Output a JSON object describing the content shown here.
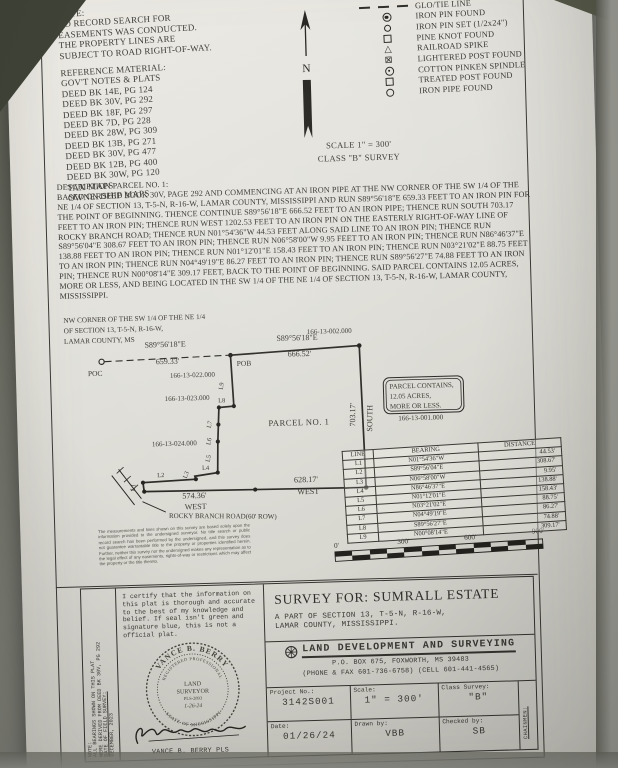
{
  "top_notes": {
    "title": "NOTE:",
    "lines": [
      "NO RECORD SEARCH FOR",
      "EASEMENTS WAS CONDUCTED.",
      "THE PROPERTY LINES ARE",
      "SUBJECT TO ROAD RIGHT-OF-WAY."
    ],
    "reference_title": "REFERENCE MATERIAL:",
    "reference_items": [
      "GOV'T NOTES & PLATS",
      "DEED BK 14E, PG 124",
      "DEED BK 30V, PG 292",
      "DEED BK 18F, PG 297",
      "DEED BK 7D, PG 228",
      "DEED BK 28W, PG 309",
      "DEED BK 13B, PG 271",
      "DEED BK 30V, PG 477",
      "DEED BK 12B, PG 400",
      "DEED BK 30W, PG 120",
      "TAX MAPS",
      "OWNERSHIP MAPS"
    ]
  },
  "compass": {
    "label": "N"
  },
  "legend": {
    "items": [
      {
        "label": "PROPERTY LINE"
      },
      {
        "label": "GLO/TIE LINE"
      },
      {
        "label": "IRON PIN FOUND"
      },
      {
        "label": "IRON PIN SET (1/2x24\")"
      },
      {
        "label": "PINE KNOT FOUND"
      },
      {
        "label": "RAILROAD SPIKE"
      },
      {
        "label": "LIGHTERED POST FOUND"
      },
      {
        "label": "COTTON PINKEN SPINDLE"
      },
      {
        "label": "TREATED POST FOUND"
      },
      {
        "label": "IRON PIPE FOUND"
      }
    ]
  },
  "scale_note": {
    "scale": "SCALE 1\" = 300'",
    "survey_class": "CLASS \"B\" SURVEY"
  },
  "description": {
    "title": "DESCRIPTION PARCEL NO. 1:",
    "body": "BASED ON DEED BOOK 30V, PAGE 292 AND COMMENCING AT AN IRON PIPE AT THE NW CORNER OF THE SW 1/4 OF THE NE 1/4 OF SECTION 13, T-5-N, R-16-W, LAMAR COUNTY, MISSISSIPPI AND RUN S89°56'18\"E 659.33 FEET TO AN IRON PIN FOR THE POINT OF BEGINNING. THENCE CONTINUE S89°56'18\"E 666.52 FEET TO AN IRON PIPE; THENCE RUN SOUTH 703.17 FEET TO AN IRON PIN; THENCE RUN WEST 1202.53 FEET TO AN IRON PIN ON THE EASTERLY RIGHT-OF-WAY LINE OF ROCKY BRANCH ROAD; THENCE RUN N01°54'36\"W 44.53 FEET ALONG SAID LINE TO AN IRON PIN; THENCE RUN S89°56'04\"E 308.67 FEET TO AN IRON PIN; THENCE RUN N06°58'00\"W 9.95 FEET TO AN IRON PIN; THENCE RUN N86°46'37\"E 138.88 FEET TO AN IRON PIN; THENCE RUN N01°12'01\"E 158.43 FEET TO AN IRON PIN; THENCE RUN N03°21'02\"E 88.75 FEET TO AN IRON PIN; THENCE RUN N04°49'19\"E 86.27 FEET TO AN IRON PIN; THENCE RUN S89°56'27\"E 74.88 FEET TO AN IRON PIN; THENCE RUN N00°08'14\"E 309.17 FEET, BACK TO THE POINT OF BEGINNING. SAID PARCEL CONTAINS 12.05 ACRES, MORE OR LESS, AND BEING LOCATED IN THE SW 1/4 OF THE NE 1/4 OF SECTION 13, T-5-N, R-16-W, LAMAR COUNTY, MISSISSIPPI."
  },
  "plat": {
    "nw_corner_lines": [
      "NW CORNER OF THE SW 1/4 OF THE NE 1/4",
      "OF SECTION 13, T-5-N, R-16-W,",
      "LAMAR COUNTY, MS"
    ],
    "poc": "POC",
    "pob": "POB",
    "tie_bearing": "S89°56'18\"E",
    "tie_distance": "659.33'",
    "north_bearing": "S89°56'18\"E",
    "north_distance": "666.52'",
    "east_distance": "703.17'",
    "east_direction": "SOUTH",
    "south_distance_east": "628.17'",
    "south_direction_east": "WEST",
    "south_distance_west": "574.36'",
    "south_direction_west": "WEST",
    "road_label": "ROCKY BRANCH ROAD(60' ROW)",
    "parcel_label": "PARCEL NO. 1",
    "parcel_note_lines": [
      "PARCEL CONTAINS,",
      "12.05 ACRES,",
      "MORE OR LESS."
    ],
    "tract_ids": {
      "north": "166-13-002.000",
      "tie": "166-13-022.000",
      "west_upper": "166-13-023.000",
      "west_lower": "166-13-024.000",
      "east": "166-13-001.000"
    },
    "segment_labels": [
      "L1",
      "L2",
      "L3",
      "L4",
      "L5",
      "L6",
      "L7",
      "L8",
      "L9"
    ],
    "line_table": {
      "headers": [
        "LINE",
        "BEARING",
        "DISTANCE"
      ],
      "rows": [
        [
          "L1",
          "N01°54'36\"W",
          "44.53'"
        ],
        [
          "L2",
          "S89°56'04\"E",
          "308.67'"
        ],
        [
          "L3",
          "N06°58'00\"W",
          "9.95'"
        ],
        [
          "L4",
          "N86°46'37\"E",
          "138.88'"
        ],
        [
          "L5",
          "N01°12'01\"E",
          "158.43'"
        ],
        [
          "L6",
          "N03°21'02\"E",
          "88.75'"
        ],
        [
          "L7",
          "N04°49'19\"E",
          "86.27'"
        ],
        [
          "L8",
          "S89°56'27\"E",
          "74.88'"
        ],
        [
          "L9",
          "N00°08'14\"E",
          "309.17'"
        ]
      ]
    },
    "scale_bar_labels": [
      "0'",
      "300'",
      "600'",
      "900'"
    ],
    "disclaimer": "The measurements and lines shown on this survey are based solely upon the information provided to the undersigned surveyor. No title search or public record search has been performed by the undersigned, and this survey does not guarantee warrantable title to the property or properties identified herein. Further, neither this survey nor the undersigned makes any representation as to the legal effect of any easements, rights-of-way or restrictions which may affect the property or the title thereto."
  },
  "title_block": {
    "side_notes": {
      "note_line1": "NOTE:",
      "note_line2": "ALL BEARINGS SHOWN ON THIS PLAT",
      "note_line3": "WERE DERIVED FROM DEED BK 30V, PG 292",
      "date_label": "DATE OF FIELD SURVEY:",
      "date_value": "DECEMBER, 2023"
    },
    "certification": "I certify that the information on this plat is thorough and accurate to the best of my knowledge and belief. If seal isn't green and signature blue, this is not a official plat.",
    "seal": {
      "name": "VANCE B. BERRY",
      "title": "REGISTERED PROFESSIONAL",
      "line1": "LAND",
      "line2": "SURVEYOR",
      "line3": "PLS-2893",
      "line4": "1-26-24",
      "state": "STATE OF MISSISSIPPI"
    },
    "signature_name": "VANCE B. BERRY PLS",
    "survey_for": {
      "title": "SURVEY FOR: SUMRALL ESTATE",
      "subtitle_line1": "A PART OF SECTION 13, T-5-N, R-16-W,",
      "subtitle_line2": "LAMAR COUNTY, MISSISSIPPI."
    },
    "company": {
      "name": "LAND DEVELOPMENT AND SURVEYING",
      "address": "P.O. BOX 675, FOXWORTH, MS 39483",
      "phone": "(PHONE & FAX 601-736-6758) (CELL 601-441-4565)"
    },
    "info": {
      "project_label": "Project No.:",
      "project_value": "3142S001",
      "scale_label": "Scale:",
      "scale_value": "1\" = 300'",
      "class_label": "Class Survey:",
      "class_value": "\"B\"",
      "date_label": "Date:",
      "date_value": "01/26/24",
      "drawn_label": "Drawn by:",
      "drawn_value": "VBB",
      "checked_label": "Checked by:",
      "checked_value": "SB",
      "chainmen_label": "CHAINMEN:"
    }
  }
}
